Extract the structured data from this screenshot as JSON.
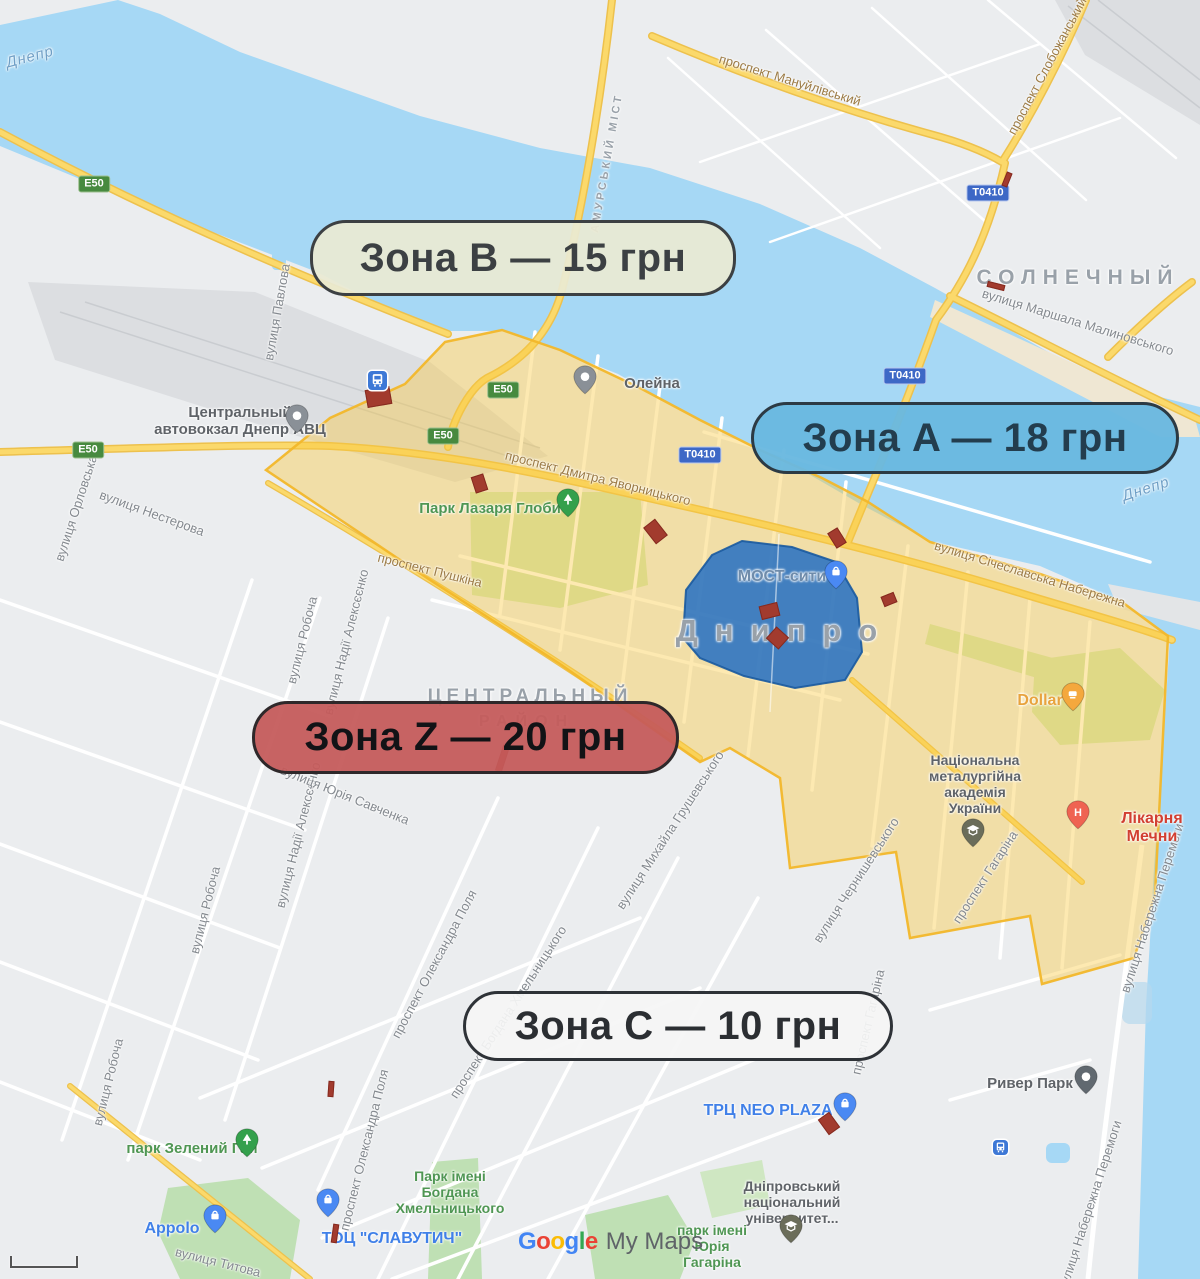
{
  "zone_pills": [
    {
      "id": "b",
      "label": "Зона B — 15 грн",
      "x": 310,
      "y": 220,
      "w": 420,
      "h": 70,
      "bg": "rgba(233,233,211,0.93)",
      "border": "#3c4043",
      "color": "#3c4043"
    },
    {
      "id": "a",
      "label": "Зона A — 18 грн",
      "x": 751,
      "y": 402,
      "w": 422,
      "h": 66,
      "bg": "rgba(105,184,224,0.96)",
      "border": "#2c3a44",
      "color": "#233d4e"
    },
    {
      "id": "z",
      "label": "Зона Z — 20 грн",
      "x": 252,
      "y": 701,
      "w": 421,
      "h": 67,
      "bg": "rgba(197,90,90,0.94)",
      "border": "#2e282a",
      "color": "#121316"
    },
    {
      "id": "c",
      "label": "Зона C — 10 грн",
      "x": 463,
      "y": 991,
      "w": 424,
      "h": 64,
      "bg": "rgba(245,245,245,0.92)",
      "border": "#2e3237",
      "color": "#2b2e32"
    }
  ],
  "districts": [
    {
      "text": "СОЛНЕЧНЫЙ",
      "x": 1078,
      "y": 278,
      "size": 21,
      "ls": 7,
      "rot": 0
    },
    {
      "text": "Днипро",
      "x": 785,
      "y": 631,
      "size": 31,
      "ls": 17,
      "rot": 0
    },
    {
      "text": "ЦЕНТРАЛЬНЫЙ",
      "x": 530,
      "y": 697,
      "size": 19,
      "ls": 5,
      "rot": 0
    },
    {
      "text": "РАЙОН",
      "x": 527,
      "y": 722,
      "size": 16,
      "ls": 8,
      "rot": 0
    },
    {
      "text": "АМУРСЬКИЙ МІСТ",
      "x": 607,
      "y": 163,
      "size": 11,
      "ls": 3,
      "rot": -80
    }
  ],
  "water_labels": [
    {
      "text": "Днепр",
      "x": 30,
      "y": 57,
      "rot": -15
    },
    {
      "text": "Днепр",
      "x": 1146,
      "y": 489,
      "rot": -18
    }
  ],
  "street_labels": [
    {
      "text": "проспект Мануйлівський",
      "x": 790,
      "y": 80,
      "rot": 17,
      "cls": "road"
    },
    {
      "text": "проспект Слобожанський",
      "x": 1047,
      "y": 66,
      "rot": -62,
      "cls": "road"
    },
    {
      "text": "вулиця Маршала Малиновського",
      "x": 1078,
      "y": 322,
      "rot": 17,
      "cls": "gray"
    },
    {
      "text": "вулиця Павлова",
      "x": 277,
      "y": 312,
      "rot": -80,
      "cls": "gray"
    },
    {
      "text": "вулиця Орловська",
      "x": 76,
      "y": 508,
      "rot": -72,
      "cls": "gray"
    },
    {
      "text": "вулиця Нестерова",
      "x": 152,
      "y": 513,
      "rot": 20,
      "cls": "gray"
    },
    {
      "text": "проспект Дмитра Яворницького",
      "x": 598,
      "y": 478,
      "rot": 14,
      "cls": "road"
    },
    {
      "text": "вулиця Січеславська Набережна",
      "x": 1030,
      "y": 574,
      "rot": 17,
      "cls": "road"
    },
    {
      "text": "проспект Пушкіна",
      "x": 430,
      "y": 570,
      "rot": 14,
      "cls": "road"
    },
    {
      "text": "вулиця Робоча",
      "x": 302,
      "y": 640,
      "rot": -76,
      "cls": "gray"
    },
    {
      "text": "вулиця Робоча",
      "x": 205,
      "y": 910,
      "rot": -76,
      "cls": "gray"
    },
    {
      "text": "вулиця Робоча",
      "x": 108,
      "y": 1082,
      "rot": -76,
      "cls": "gray"
    },
    {
      "text": "вулиця Надії Алексєєнко",
      "x": 346,
      "y": 642,
      "rot": -76,
      "cls": "gray"
    },
    {
      "text": "вулиця Надії Алексєєнко",
      "x": 298,
      "y": 835,
      "rot": -76,
      "cls": "gray"
    },
    {
      "text": "вулиця Юрія Савченка",
      "x": 345,
      "y": 795,
      "rot": 22,
      "cls": "gray"
    },
    {
      "text": "вулиця Чернишевського",
      "x": 856,
      "y": 880,
      "rot": -57,
      "cls": "gray"
    },
    {
      "text": "проспект Гагаріна",
      "x": 985,
      "y": 877,
      "rot": -57,
      "cls": "gray"
    },
    {
      "text": "проспект Гагаріна",
      "x": 868,
      "y": 1022,
      "rot": -77,
      "cls": "gray"
    },
    {
      "text": "вулиця Набережна Перемоги",
      "x": 1152,
      "y": 908,
      "rot": -72,
      "cls": "gray"
    },
    {
      "text": "вулиця Набережна Перемоги",
      "x": 1090,
      "y": 1205,
      "rot": -72,
      "cls": "gray"
    },
    {
      "text": "вулиця Михайла Грушевського",
      "x": 670,
      "y": 830,
      "rot": -57,
      "cls": "gray"
    },
    {
      "text": "проспект Олександра Поля",
      "x": 434,
      "y": 964,
      "rot": -62,
      "cls": "gray"
    },
    {
      "text": "проспект Олександра Поля",
      "x": 364,
      "y": 1150,
      "rot": -76,
      "cls": "gray"
    },
    {
      "text": "проспект Богдана Хмельницького",
      "x": 508,
      "y": 1012,
      "rot": -57,
      "cls": "gray"
    },
    {
      "text": "вулиця Титова",
      "x": 218,
      "y": 1262,
      "rot": 14,
      "cls": "gray"
    }
  ],
  "poi_labels": [
    {
      "lines": [
        "Центральный",
        "автовокзал Днепр АВЦ"
      ],
      "x": 240,
      "y": 404,
      "cls": "poi-gray",
      "size": 15
    },
    {
      "lines": [
        "Олейна"
      ],
      "x": 652,
      "y": 375,
      "cls": "poi-gray",
      "size": 15
    },
    {
      "lines": [
        "Парк Лазаря Глоби"
      ],
      "x": 490,
      "y": 500,
      "cls": "park",
      "size": 15
    },
    {
      "lines": [
        "МОСТ-сити"
      ],
      "x": 782,
      "y": 568,
      "cls": "mostcity",
      "size": 16
    },
    {
      "lines": [
        "Dollar"
      ],
      "x": 1040,
      "y": 692,
      "cls": "poi-orange",
      "size": 16
    },
    {
      "lines": [
        "Національна",
        "металургійна",
        "академія",
        "України"
      ],
      "x": 975,
      "y": 752,
      "cls": "poi-gray",
      "size": 14
    },
    {
      "lines": [
        "Лікарня Мечни"
      ],
      "x": 1152,
      "y": 810,
      "cls": "poi-red",
      "size": 16
    },
    {
      "lines": [
        "Ривер Парк"
      ],
      "x": 1030,
      "y": 1075,
      "cls": "poi-gray",
      "size": 15
    },
    {
      "lines": [
        "ТРЦ NEO PLAZA"
      ],
      "x": 768,
      "y": 1102,
      "cls": "poi-blue",
      "size": 16
    },
    {
      "lines": [
        "Дніпровський",
        "національний",
        "університет..."
      ],
      "x": 792,
      "y": 1178,
      "cls": "poi-gray",
      "size": 14
    },
    {
      "lines": [
        "парк імені",
        "Юрія",
        "Гагаріна"
      ],
      "x": 712,
      "y": 1222,
      "cls": "park",
      "size": 14
    },
    {
      "lines": [
        "парк Зелений Гай",
        "x"
      ],
      "x": 192,
      "y": 1140,
      "cls": "park",
      "size": 15
    },
    {
      "lines": [
        "Appolo"
      ],
      "x": 172,
      "y": 1220,
      "cls": "poi-blue",
      "size": 16
    },
    {
      "lines": [
        "ТОЦ \"СЛАВУТИЧ\""
      ],
      "x": 392,
      "y": 1230,
      "cls": "poi-blue",
      "size": 16
    },
    {
      "lines": [
        "Парк імені",
        "Богдана",
        "Хмельницького"
      ],
      "x": 450,
      "y": 1168,
      "cls": "park",
      "size": 14
    }
  ],
  "road_badges": [
    {
      "t": "E50",
      "k": "e",
      "x": 94,
      "y": 184
    },
    {
      "t": "E50",
      "k": "e",
      "x": 88,
      "y": 450
    },
    {
      "t": "E50",
      "k": "e",
      "x": 443,
      "y": 436
    },
    {
      "t": "E50",
      "k": "e",
      "x": 503,
      "y": 390
    },
    {
      "t": "T0410",
      "k": "t",
      "x": 988,
      "y": 193
    },
    {
      "t": "T0410",
      "k": "t",
      "x": 905,
      "y": 376
    },
    {
      "t": "T0410",
      "k": "t",
      "x": 700,
      "y": 455
    }
  ],
  "pins": [
    {
      "t": "shop",
      "x": 836,
      "y": 572
    },
    {
      "t": "shop",
      "x": 845,
      "y": 1104
    },
    {
      "t": "shop",
      "x": 215,
      "y": 1216
    },
    {
      "t": "shop",
      "x": 328,
      "y": 1200
    },
    {
      "t": "gray",
      "x": 297,
      "y": 416
    },
    {
      "t": "gray",
      "x": 585,
      "y": 377
    },
    {
      "t": "dark",
      "x": 1086,
      "y": 1077
    },
    {
      "t": "tree",
      "x": 568,
      "y": 500
    },
    {
      "t": "tree",
      "x": 247,
      "y": 1140
    },
    {
      "t": "cafe",
      "x": 1073,
      "y": 694
    },
    {
      "t": "hospital",
      "x": 1078,
      "y": 812
    },
    {
      "t": "school",
      "x": 973,
      "y": 830
    },
    {
      "t": "school",
      "x": 791,
      "y": 1226
    },
    {
      "t": "transit-lg",
      "x": 377,
      "y": 380
    },
    {
      "t": "transit-sm",
      "x": 1000,
      "y": 1147
    }
  ],
  "red_markers": [
    {
      "x": 377,
      "y": 396,
      "w": 23,
      "h": 16,
      "r": -10
    },
    {
      "x": 478,
      "y": 482,
      "w": 11,
      "h": 15,
      "r": -18
    },
    {
      "x": 654,
      "y": 530,
      "w": 13,
      "h": 19,
      "r": -38
    },
    {
      "x": 836,
      "y": 537,
      "w": 10,
      "h": 16,
      "r": -32
    },
    {
      "x": 768,
      "y": 610,
      "w": 17,
      "h": 12,
      "r": -14
    },
    {
      "x": 776,
      "y": 637,
      "w": 15,
      "h": 14,
      "r": 42
    },
    {
      "x": 888,
      "y": 598,
      "w": 12,
      "h": 9,
      "r": -22
    },
    {
      "x": 1006,
      "y": 178,
      "w": 4,
      "h": 13,
      "r": 22
    },
    {
      "x": 995,
      "y": 285,
      "w": 16,
      "h": 4,
      "r": 14
    },
    {
      "x": 828,
      "y": 1122,
      "w": 12,
      "h": 17,
      "r": -36
    },
    {
      "x": 334,
      "y": 1232,
      "w": 4,
      "h": 17,
      "r": 8
    },
    {
      "x": 501,
      "y": 757,
      "w": 5,
      "h": 25,
      "r": 18
    },
    {
      "x": 330,
      "y": 1088,
      "w": 4,
      "h": 14,
      "r": 4
    }
  ],
  "attribution": {
    "google_letters": [
      {
        "ch": "G",
        "c": "#4285F4"
      },
      {
        "ch": "o",
        "c": "#EA4335"
      },
      {
        "ch": "o",
        "c": "#FBBC05"
      },
      {
        "ch": "g",
        "c": "#4285F4"
      },
      {
        "ch": "l",
        "c": "#34A853"
      },
      {
        "ch": "e",
        "c": "#EA4335"
      }
    ],
    "suffix": "My Maps"
  },
  "colors": {
    "water": "#a6d8f5",
    "land": "#ebedef",
    "yellow_zone_fill": "rgba(250,200,60,0.40)",
    "yellow_zone_stroke": "rgba(242,183,42,0.95)",
    "blue_zone_fill": "rgba(35,110,195,0.85)",
    "blue_zone_stroke": "rgba(25,90,160,0.9)",
    "marker_red": "#a23b2e",
    "road_yellow": "#fbd96b"
  }
}
